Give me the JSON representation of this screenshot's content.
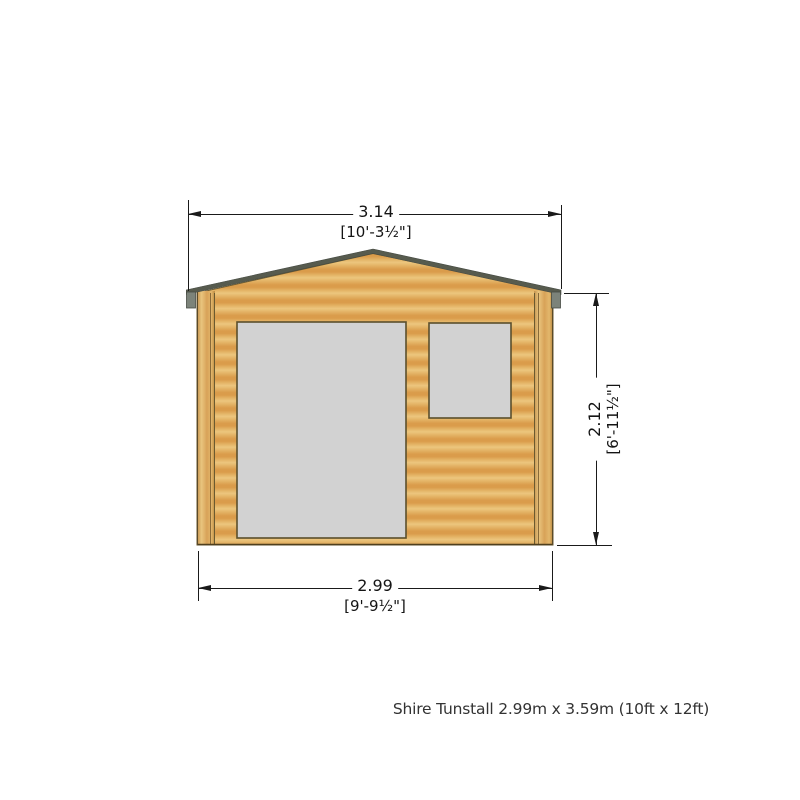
{
  "caption": "Shire Tunstall 2.99m x 3.59m (10ft x 12ft)",
  "dimensions": {
    "overall_width": {
      "metric_m": "3.14",
      "imperial": "[10'-3½\"]"
    },
    "eaves_height": {
      "metric_m": "2.12",
      "imperial": "[6'-11½\"]"
    },
    "wall_width": {
      "metric_m": "2.99",
      "imperial": "[9'-9½\"]"
    }
  },
  "drawing": {
    "subject": "log-cabin-front-elevation",
    "parts": [
      "gable-roof",
      "roof-end-tabs",
      "log-wall",
      "corner-posts",
      "door",
      "window"
    ],
    "colors": {
      "wood_light": "#ecc67e",
      "wood_dark": "#da9c4b",
      "roof_fascia": "#575b4e",
      "roof_end_tab": "#7c837a",
      "opening_fill": "#d2d2d2",
      "opening_border": "#5b4f2c",
      "wall_outline": "#6b5a30",
      "dimension_line": "#1a1a1a",
      "caption_text": "#333333"
    }
  }
}
